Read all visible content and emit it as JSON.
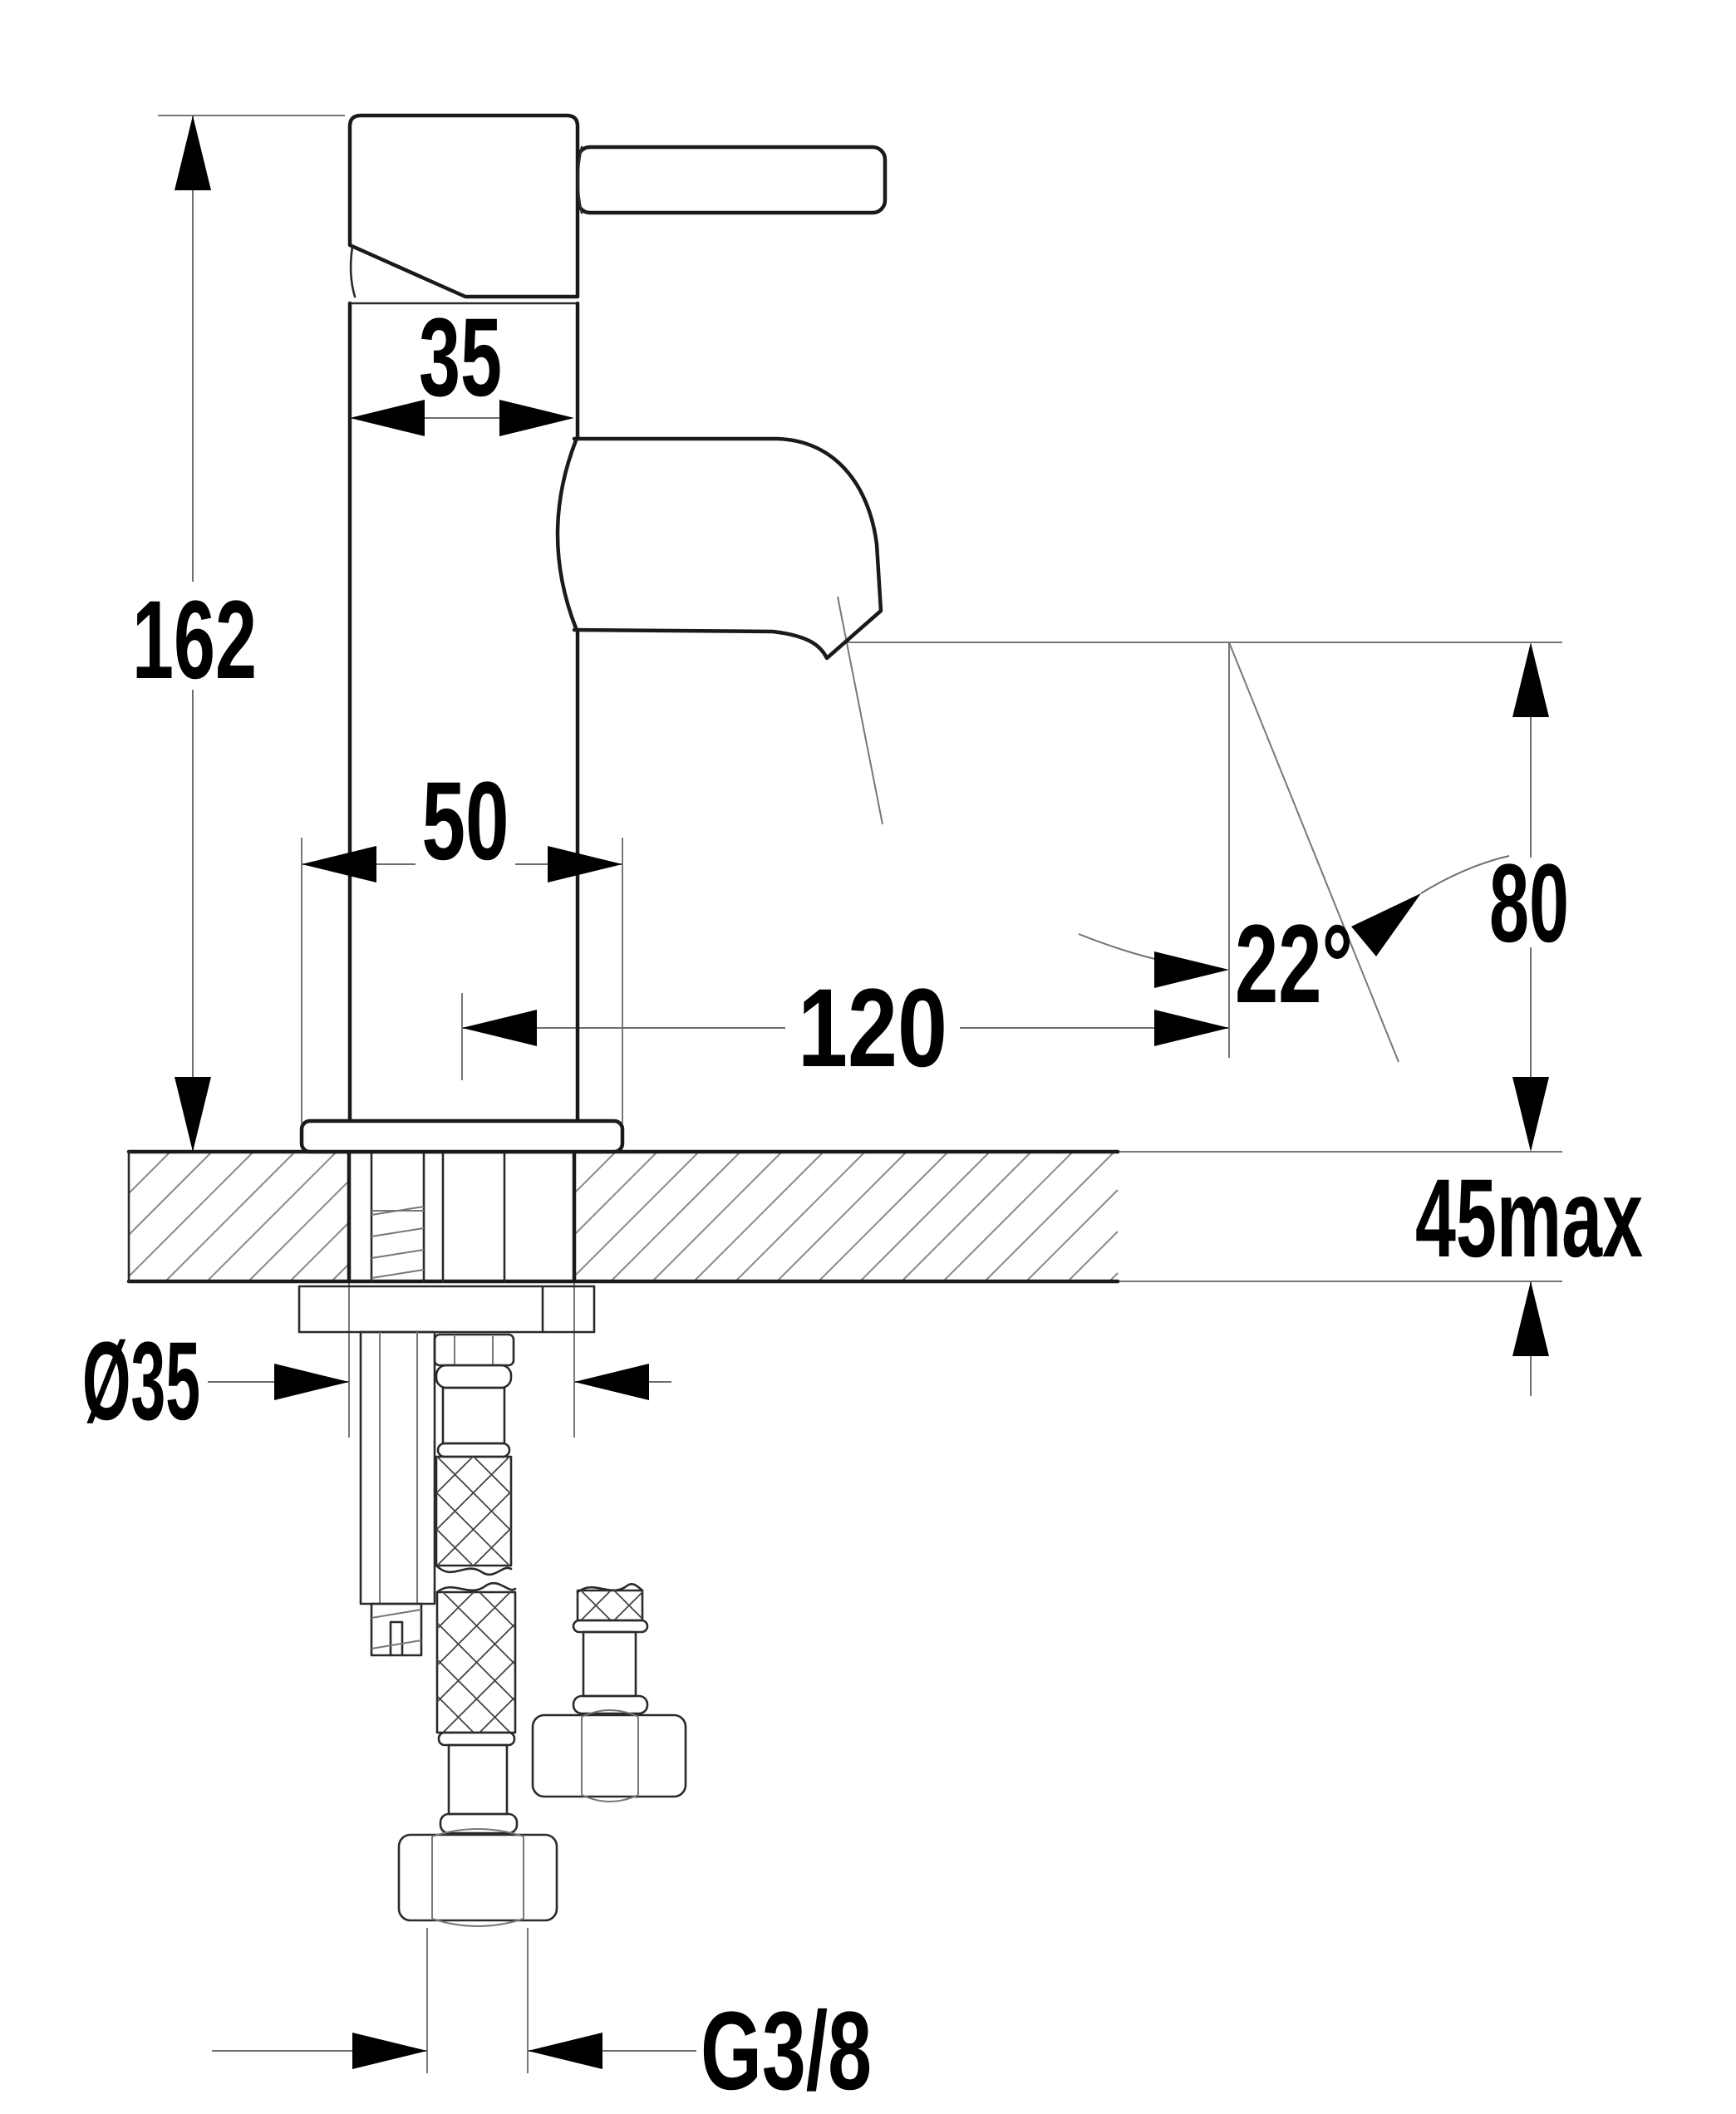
{
  "drawing": {
    "title": "basin-mixer-installation-dimension-drawing",
    "dimensions": {
      "overall_height": "162",
      "body_width": "35",
      "base_width": "50",
      "spout_reach": "120",
      "spout_angle": "22°",
      "spout_height": "80",
      "deck_thickness": "45max",
      "hole_diameter": "Ø35",
      "connection_thread": "G3/8"
    },
    "colors": {
      "object_line": "#1a1a1a",
      "dimension_line": "#6e6e6e",
      "hatch_line": "#888888",
      "background": "#ffffff"
    }
  }
}
